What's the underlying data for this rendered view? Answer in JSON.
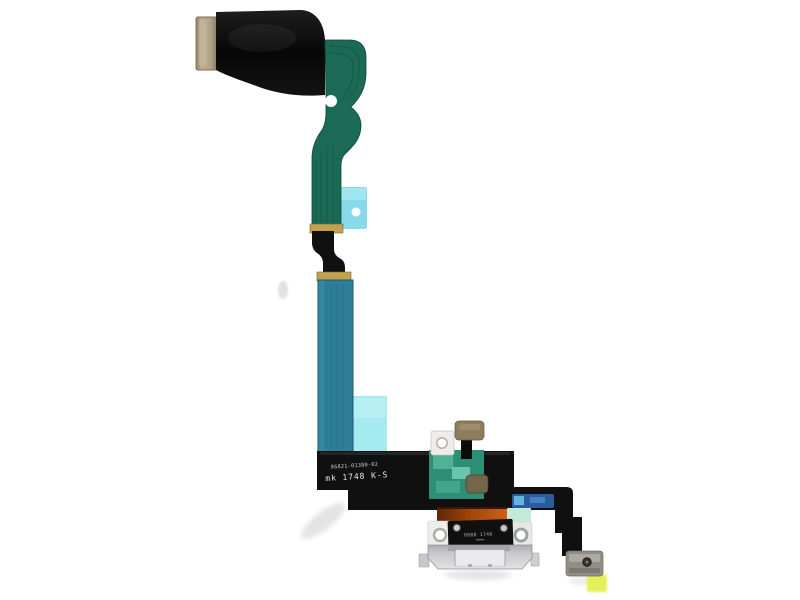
{
  "image": {
    "type": "product-photo",
    "subject": "Charging port Lightning connector flex cable assembly (white), photographed on white background",
    "background": "#ffffff"
  },
  "markings": {
    "flex_part_number": "06821-01380-02",
    "flex_batch_code": "mk 1748 K-S",
    "connector_marking": "8888 1748"
  },
  "colors": {
    "flex_black": "#101010",
    "flex_green": "#1a6a55",
    "flex_blue": "#2f7e98",
    "solder_gold": "#c2a24e",
    "contact_tab_tan": "#b3a58a",
    "adhesive_cyan": "#87dbe8",
    "adhesive_cyan_light": "#a5e9f1",
    "adhesive_blue_strip": "#2b5c9e",
    "copper_orange": "#c05511",
    "mint_pad": "#c3ead9",
    "module_green": "#2f8f76",
    "mic_tan": "#8d7f5e",
    "mic_tan_dark": "#746648",
    "bracket_white": "#efede9",
    "housing_silver": "#c9c9cd",
    "metal_bracket_gray": "#908e86",
    "highlight_yellow": "#e4f05a"
  }
}
